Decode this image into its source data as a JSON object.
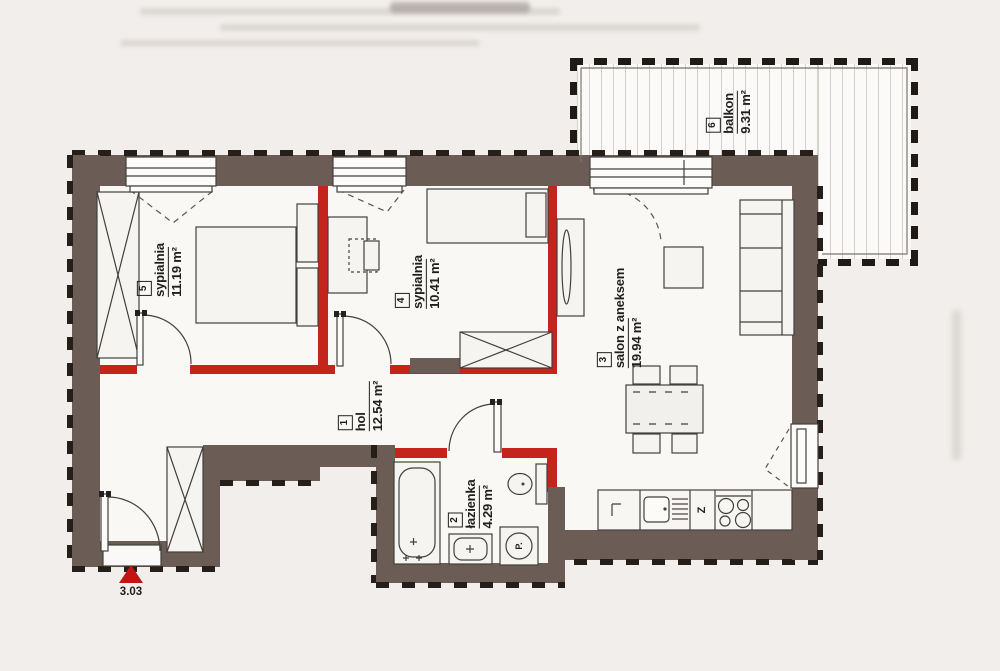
{
  "plan": {
    "rooms": [
      {
        "number": "1",
        "name": "hol",
        "area": "12.54 m²"
      },
      {
        "number": "2",
        "name": "łazienka",
        "area": "4.29 m²"
      },
      {
        "number": "3",
        "name": "salon z aneksem",
        "area": "19.94 m²"
      },
      {
        "number": "4",
        "name": "sypialnia",
        "area": "10.41 m²"
      },
      {
        "number": "5",
        "name": "sypialnia",
        "area": "11.19 m²"
      },
      {
        "number": "6",
        "name": "balkon",
        "area": "9.31 m²"
      }
    ],
    "entrance": {
      "level_marker": "3.03"
    },
    "appliance_labels": {
      "washing_machine": "P.",
      "dishwasher": "Z"
    },
    "colors": {
      "exterior_wall": "#6b5d55",
      "partition_wall": "#c5241c",
      "entrance_marker": "#c31414"
    }
  }
}
